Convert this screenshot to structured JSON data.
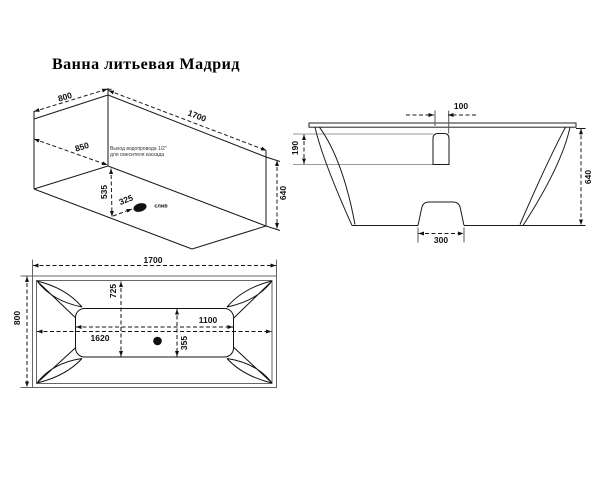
{
  "title": "Ванна литьевая Мадрид",
  "views": {
    "iso": {
      "dims": {
        "width": "800",
        "length": "1700",
        "slope_width": "850",
        "drain_depth": "535",
        "drain_offset": "325",
        "height": "640"
      },
      "drain_label": "слив",
      "note_line1": "Выход водопровода 1/2\"",
      "note_line2": "для смесителя каскада"
    },
    "side": {
      "dims": {
        "cascade_width": "100",
        "cascade_depth": "190",
        "height": "640",
        "foot_width": "300"
      }
    },
    "plan": {
      "dims": {
        "length": "1700",
        "width": "800",
        "bowl_offset": "725",
        "bowl_length": "1100",
        "rim_length": "1620",
        "bowl_width": "355"
      }
    }
  }
}
